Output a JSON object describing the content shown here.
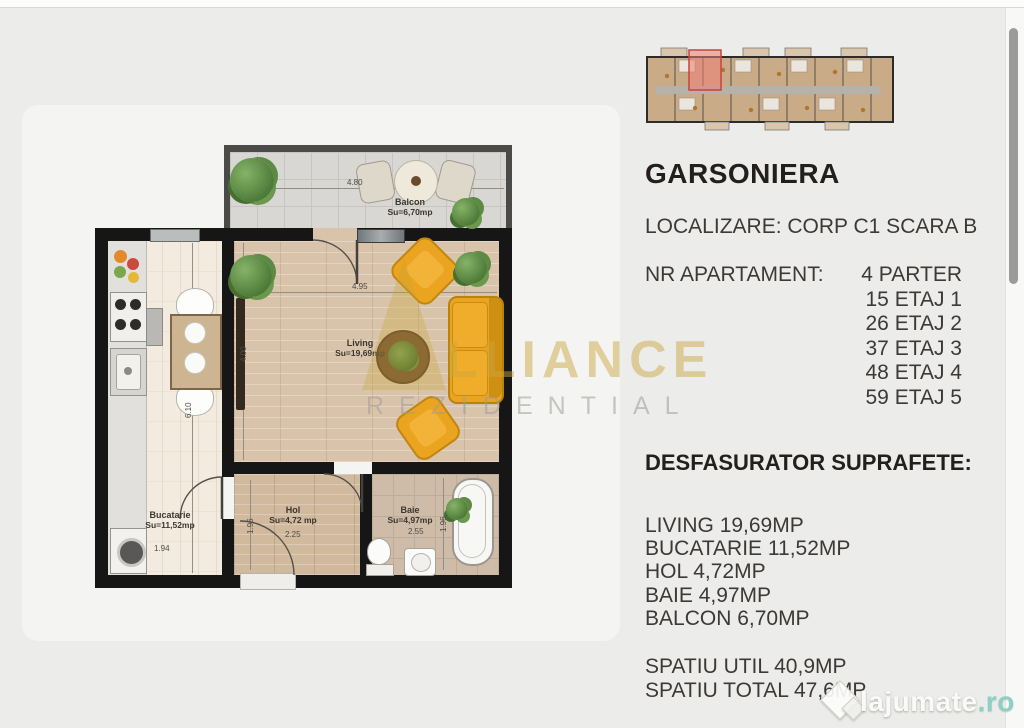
{
  "info_panel": {
    "title": "GARSONIERA",
    "localization": "LOCALIZARE: CORP C1 SCARA B",
    "apartments_label": "NR APARTAMENT:",
    "apartments": [
      "4 PARTER",
      "15 ETAJ 1",
      "26 ETAJ 2",
      "37 ETAJ 3",
      "48 ETAJ 4",
      "59 ETAJ 5"
    ],
    "areas_title": "DESFASURATOR SUPRAFETE:",
    "areas": [
      "LIVING 19,69MP",
      "BUCATARIE 11,52MP",
      "HOL 4,72MP",
      "BAIE 4,97MP",
      "BALCON 6,70MP"
    ],
    "totals": [
      "SPATIU UTIL 40,9MP",
      "SPATIU TOTAL 47,6MP"
    ]
  },
  "floor_plan": {
    "rooms": {
      "balcon": {
        "name": "Balcon",
        "area": "Su=6,70mp",
        "width": "4.80"
      },
      "living": {
        "name": "Living",
        "area": "Su=19,69mp",
        "width": "4.95",
        "height": "4.00"
      },
      "bucatarie": {
        "name": "Bucatarie",
        "area": "Su=11,52mp",
        "width": "1.94",
        "height": "6.10"
      },
      "hol": {
        "name": "Hol",
        "area": "Su=4,72 mp",
        "width": "2.25",
        "height": "1.96"
      },
      "baie": {
        "name": "Baie",
        "area": "Su=4,97mp",
        "width": "2.55",
        "height": "1.96"
      }
    }
  },
  "watermarks": {
    "brand_line1": "LLIANCE",
    "brand_line2": "REZIDENTIAL",
    "site_name": "lajumate",
    "site_tld": ".ro"
  },
  "colors": {
    "accent_gold": "#c8a43c",
    "unit_highlight": "#e07a72",
    "furniture_orange": "#e49a1d",
    "tld_teal": "#8fd0c6"
  }
}
